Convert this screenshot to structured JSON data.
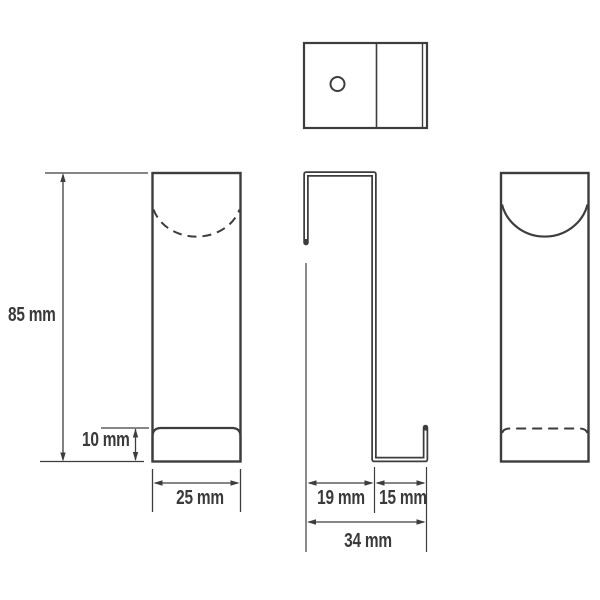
{
  "page": {
    "background_color": "#ffffff"
  },
  "drawing": {
    "line_color": "#3d3d3d",
    "text_color": "#3a3a3a",
    "dim_labels": {
      "height": "85 mm",
      "plate": "10 mm",
      "width": "25 mm",
      "inner_depth": "19 mm",
      "hook_depth": "15 mm",
      "total_depth": "34 mm"
    }
  }
}
